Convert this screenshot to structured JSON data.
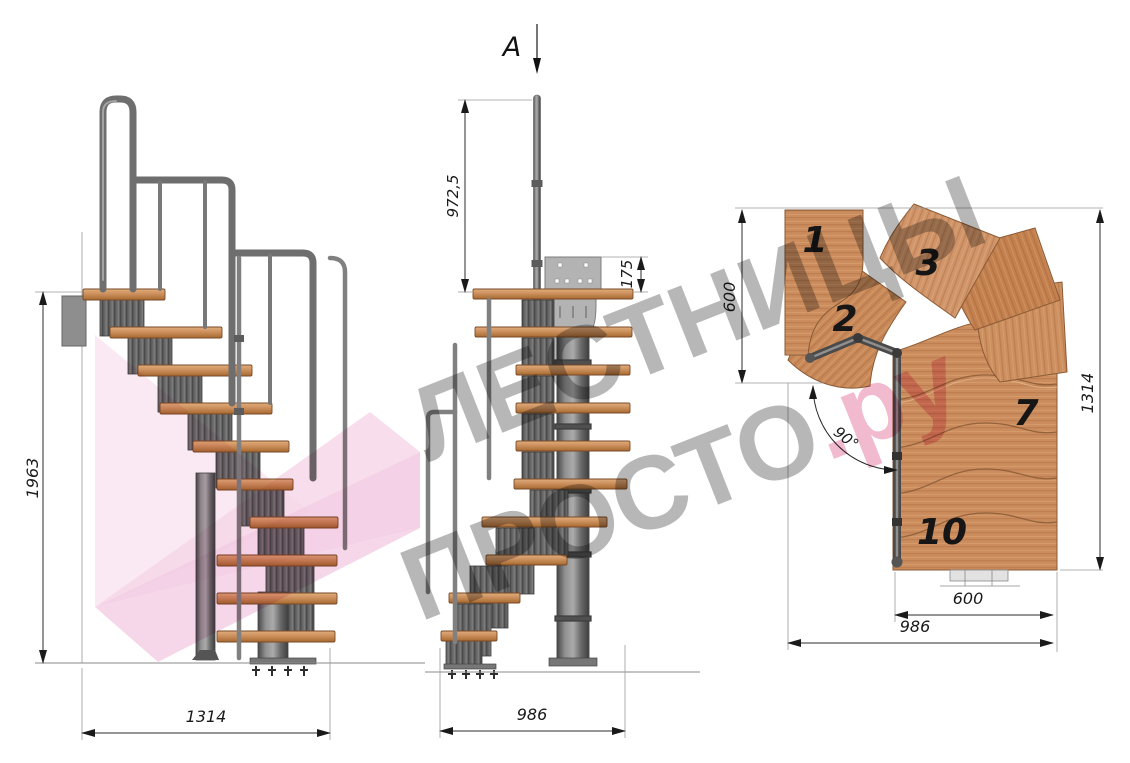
{
  "section_label": "A",
  "watermark": {
    "line1": "ЛЕСТНИЦЫ",
    "line2": "ПРОСТО",
    "suffix": ".ру"
  },
  "side_view": {
    "height_mm": "1963",
    "width_mm": "1314"
  },
  "front_view": {
    "handrail_height_mm": "972,5",
    "plate_height_mm": "175",
    "width_mm": "986"
  },
  "plan_view": {
    "entry_depth_mm": "600",
    "total_depth_mm": "1314",
    "exit_width_mm": "600",
    "total_width_mm": "986",
    "turn_angle": "90°",
    "step_numbers": [
      "1",
      "2",
      "3",
      "7",
      "10"
    ]
  },
  "colors": {
    "wood": "#c9895a",
    "metal": "#6a6a6a",
    "dimension_ink": "#1a1a1a",
    "watermark_gray": "#6f6f6f",
    "watermark_pink": "#e882a8",
    "logo_pink": "#f4c6e0"
  }
}
